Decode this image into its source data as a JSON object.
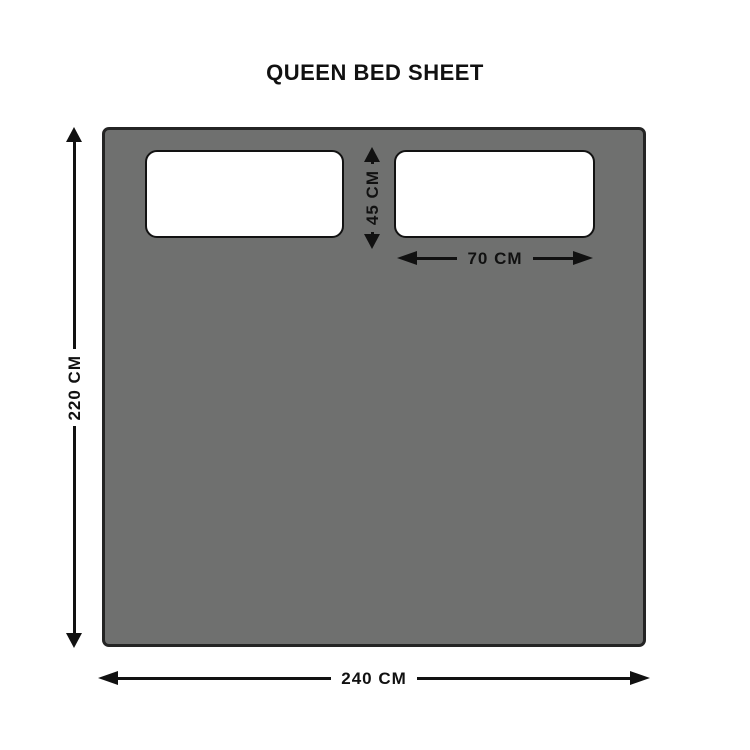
{
  "title": "QUEEN BED SHEET",
  "dimensions": {
    "sheet_height": "220 CM",
    "sheet_width": "240 CM",
    "pillow_height": "45 CM",
    "pillow_width": "70 CM"
  },
  "colors": {
    "background": "#FFFFFF",
    "ink": "#111111",
    "sheet-fill": "#6F706F",
    "sheet-border": "#242424",
    "pillow-fill": "#FFFFFF",
    "pillow-border": "#121212"
  }
}
